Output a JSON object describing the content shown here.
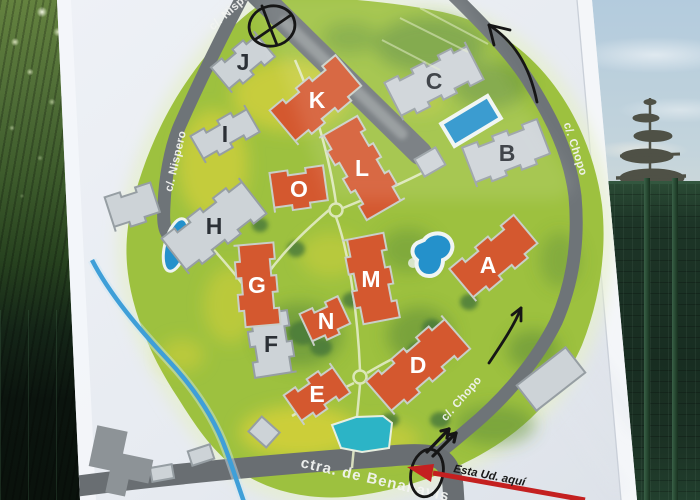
{
  "sign": {
    "map": {
      "street_labels": {
        "nispero_top": "c/. Nispero",
        "nispero": "c/. Nispero",
        "chopo_upper": "c/. Chopo",
        "chopo_lower": "c/. Chopo",
        "benahavis": "ctra. de Benahavis"
      },
      "you_are_here_label": "Esta Ud. aquí",
      "buildings": [
        {
          "label": "J",
          "type": "gray",
          "x": 243,
          "y": 62,
          "w": 56,
          "h": 33,
          "rot": -40
        },
        {
          "label": "I",
          "type": "gray",
          "x": 225,
          "y": 134,
          "w": 62,
          "h": 31,
          "rot": -30
        },
        {
          "label": "H",
          "type": "gray",
          "x": 214,
          "y": 226,
          "w": 98,
          "h": 45,
          "rot": -38
        },
        {
          "label": "C",
          "type": "gray",
          "x": 434,
          "y": 81,
          "w": 90,
          "h": 42,
          "rot": -27
        },
        {
          "label": "B",
          "type": "gray",
          "x": 507,
          "y": 153,
          "w": 80,
          "h": 42,
          "rot": -21
        },
        {
          "label": "F",
          "type": "gray",
          "x": 271,
          "y": 344,
          "w": 62,
          "h": 42,
          "rot": 81
        },
        {
          "label": "K",
          "type": "orange",
          "x": 317,
          "y": 100,
          "w": 86,
          "h": 45,
          "rot": -40
        },
        {
          "label": "L",
          "type": "orange",
          "x": 362,
          "y": 168,
          "w": 95,
          "h": 44,
          "rot": 60
        },
        {
          "label": "O",
          "type": "orange",
          "x": 299,
          "y": 189,
          "w": 54,
          "h": 40,
          "rot": -8
        },
        {
          "label": "G",
          "type": "orange",
          "x": 257,
          "y": 285,
          "w": 82,
          "h": 40,
          "rot": 85
        },
        {
          "label": "N",
          "type": "orange",
          "x": 326,
          "y": 321,
          "w": 42,
          "h": 35,
          "rot": -25
        },
        {
          "label": "M",
          "type": "orange",
          "x": 371,
          "y": 279,
          "w": 86,
          "h": 42,
          "rot": 79
        },
        {
          "label": "E",
          "type": "orange",
          "x": 317,
          "y": 394,
          "w": 56,
          "h": 36,
          "rot": -35
        },
        {
          "label": "D",
          "type": "orange",
          "x": 418,
          "y": 365,
          "w": 100,
          "h": 44,
          "rot": -41
        },
        {
          "label": "A",
          "type": "orange",
          "x": 495,
          "y": 258,
          "w": 84,
          "h": 42,
          "rot": -40,
          "lx": 488,
          "ly": 265
        }
      ],
      "aux_structures": [
        {
          "type": "gray",
          "x": 430,
          "y": 162,
          "w": 24,
          "h": 20,
          "rot": -30,
          "plain": true
        },
        {
          "type": "gray",
          "x": 133,
          "y": 207,
          "w": 48,
          "h": 36,
          "rot": -18
        },
        {
          "type": "gray",
          "x": 264,
          "y": 432,
          "w": 24,
          "h": 20,
          "rot": 42,
          "plain": true
        },
        {
          "type": "gray",
          "x": 162,
          "y": 473,
          "w": 22,
          "h": 14,
          "rot": -10,
          "plain": true
        },
        {
          "type": "gray",
          "x": 201,
          "y": 455,
          "w": 23,
          "h": 15,
          "rot": -18,
          "plain": true
        },
        {
          "type": "gray",
          "x": 551,
          "y": 379,
          "w": 62,
          "h": 32,
          "rot": -38,
          "plain": true
        },
        {
          "type": "dark",
          "x": 121,
          "y": 463,
          "w": 62,
          "h": 64,
          "rot": 12,
          "lshape": true
        }
      ],
      "colors": {
        "building_orange": "#d4582f",
        "building_gray": "#cdd3d7",
        "building_dark_gray": "#8d9397",
        "road_gray": "#6e7478",
        "map_green": "#9dc13f",
        "pool_blue": "#2491cb",
        "pool_teal": "#2cb4c6",
        "river_blue": "#3f9fd8",
        "marker_black": "#161616",
        "arrow_red": "#c42020"
      }
    }
  }
}
